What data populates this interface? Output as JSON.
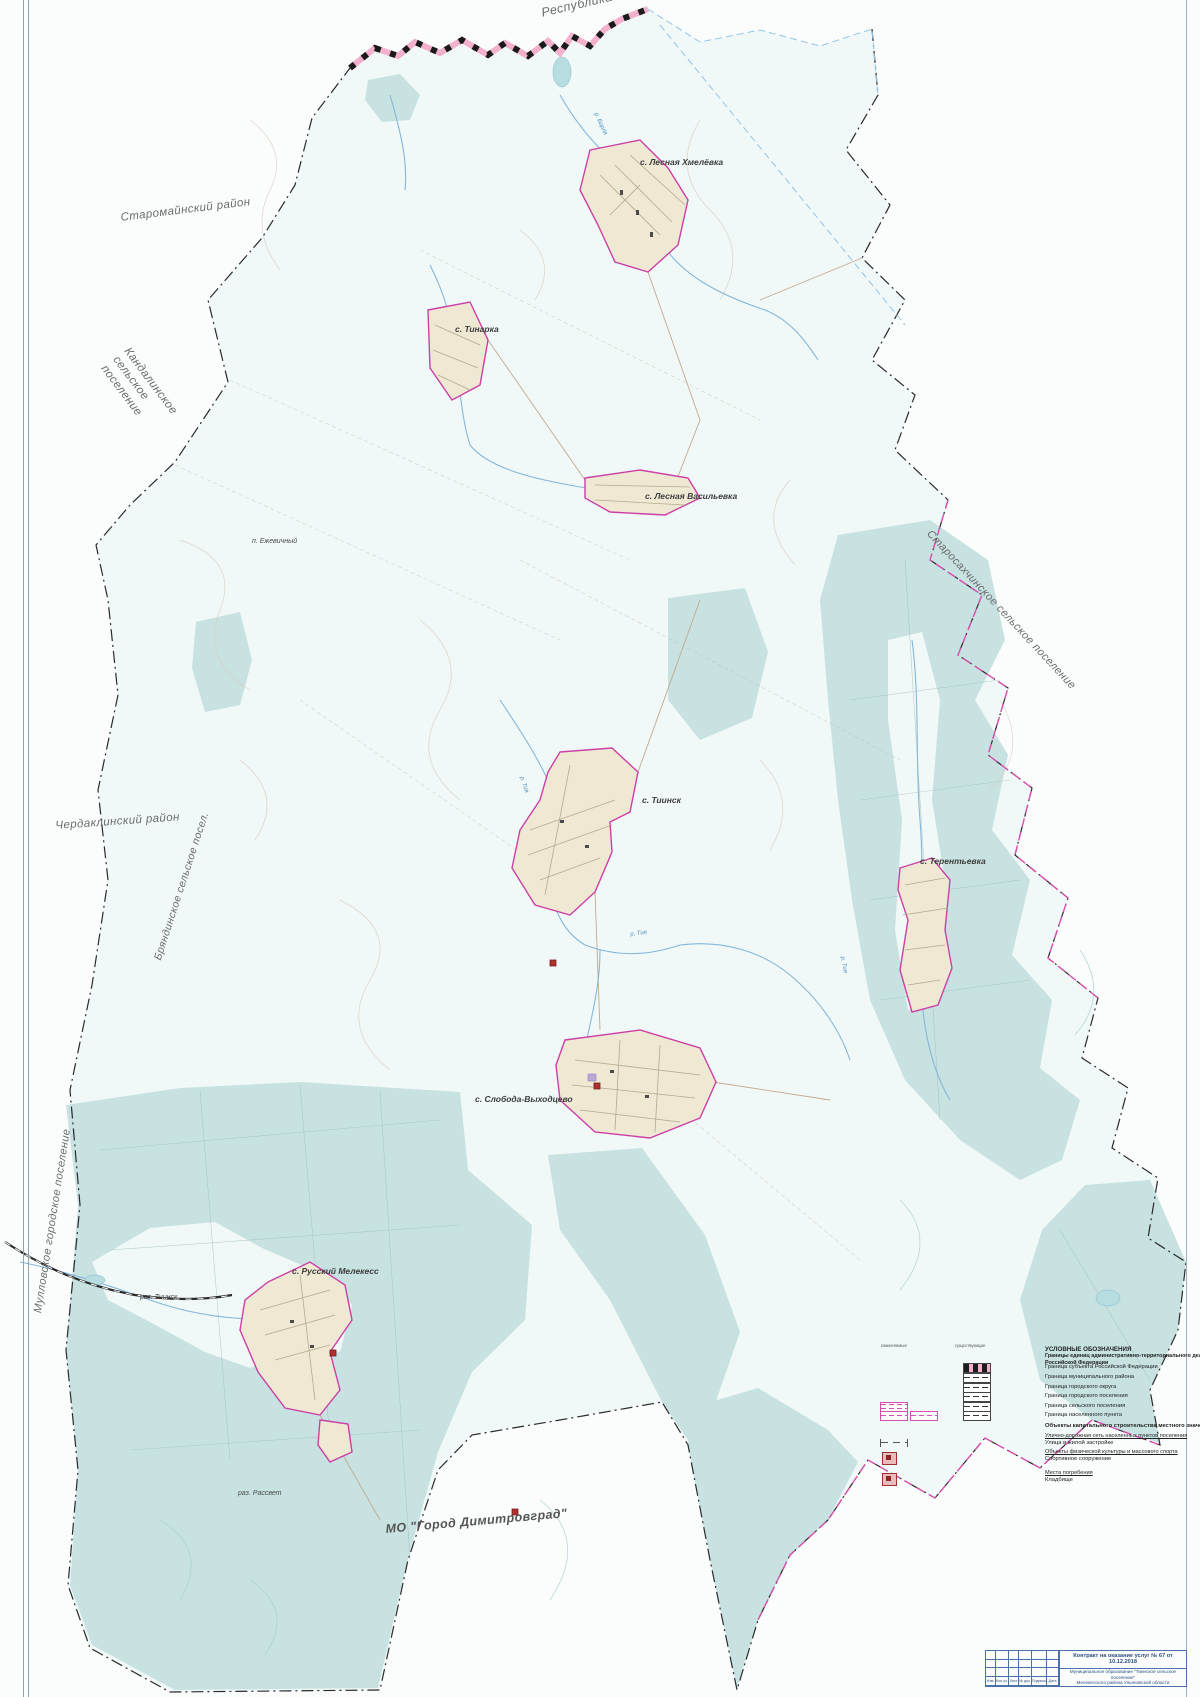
{
  "map": {
    "neighbors": {
      "tatarstan": "Республика Татарстан",
      "staromaynsky": "Старомайнский район",
      "kandalinskoe": "Кандалинское сельское поселение",
      "cherdaklinsky": "Чердаклинский район",
      "bryandinskoe": "Бряндинское сельское посел.",
      "mullovskoe": "Мулловское городское поселение",
      "starosahchinskoe": "Старосахчинское сельское поселение",
      "dimitrovgrad": "МО \"Город Димитровград\""
    },
    "settlements": {
      "lesnaya_khmelyovka": "с. Лесная Хмелёвка",
      "tinarka": "с. Тинарка",
      "lesnaya_vasilyevka": "с. Лесная Васильевка",
      "ezhevichny": "п. Ежевичный",
      "tiinsk": "с. Тиинск",
      "terentyevka": "с. Терентьевка",
      "sloboda_vykhodtsevo": "с. Слобода-Выходцево",
      "russky_melekess": "с. Русский Мелекесс",
      "raz_tiinsk": "раз. Тиинск",
      "raz_rassvet": "раз. Рассвет"
    },
    "rivers": {
      "birlya": "р. Бирля",
      "tiya": "р. Тия"
    }
  },
  "legend": {
    "title": "УСЛОВНЫЕ ОБОЗНАЧЕНИЯ",
    "subtitle": "Границы единиц административно-территориального деления Российской Федерации",
    "col_left": "изменяемые",
    "col_right": "существующие",
    "border_items": [
      "Граница субъекта Российской Федерации",
      "Граница муниципального района",
      "Граница городского округа",
      "Граница городского поселения",
      "Граница сельского поселения",
      "Граница населенного пункта"
    ],
    "section2": "Объекты капитального строительства местного значения поселения",
    "sub_roads": "Улично-дорожная сеть населенных пунктов поселения",
    "item_street": "Улица в жилой застройке",
    "sub_sport": "Объекты физической культуры и массового спорта",
    "item_sport": "Спортивное сооружение",
    "sub_burial": "Места погребения",
    "item_cemetery": "Кладбище"
  },
  "title_block": {
    "contract": "Контракт на оказание услуг № 67 от 10.12.2018",
    "municipality_line1": "Муниципальное образование \"Тиинское сельское поселение\"",
    "municipality_line2": "Мелекесского района Ульяновской области",
    "stamp_cols": [
      "Изм.",
      "Кол.уч.",
      "Лист",
      "№ док.",
      "Подпись",
      "Дата"
    ]
  },
  "colors": {
    "forest": "#c7e2e1",
    "settlement_fill": "#efe9d4",
    "settlement_border": "#cc3fa6",
    "subject_boundary_pink": "#f3b0cd",
    "municipal_boundary": "#2a2a2a",
    "changed_boundary_magenta": "#d94fb0",
    "river": "#84b7da",
    "object_red": "#b03030"
  }
}
